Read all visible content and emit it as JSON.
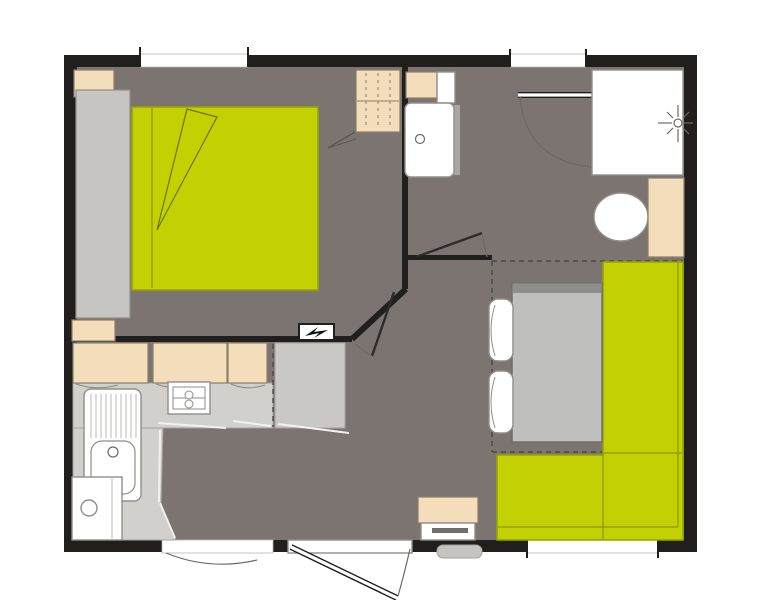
{
  "canvas": {
    "width": 769,
    "height": 600
  },
  "colors": {
    "wall": "#211f1d",
    "floor": "#7c7470",
    "accent": "#c3d102",
    "accentLine": "#95a300",
    "accentSeam": "#8a9600",
    "beige": "#f3ddbb",
    "beigeLine": "#8b7e68",
    "gray": "#c6c5c2",
    "gray2": "#c9c8c5",
    "grayLine": "#8f8e8b",
    "counter": "#d1d0cd",
    "counterLine": "#a3a29f",
    "fixture": "#ffffff",
    "fixtureLine": "#908f8c",
    "winLine": "#b9b8b5",
    "dash": "#4b4844",
    "swing": "#6b6a67",
    "leafThin": "#2e2c2a",
    "highlight": "#f2f1ef",
    "drain": "#b9b8b5",
    "step": "#c6c4c1",
    "tableTop": "#bfbfbd",
    "tableEdge": "#6f6e6c",
    "tableShadow": "#8f8e8c",
    "bolt": "#111111",
    "heaterBar": "#6f6e6c",
    "shadowStrip": "#a8a6a2"
  },
  "elements": {
    "plan": "studio-floor-plan",
    "rooms": [
      "bedroom",
      "bathroom",
      "kitchen",
      "living-area"
    ],
    "bedroom_items": [
      "double-bed",
      "wardrobe",
      "nightstand",
      "low-cabinet",
      "hanging-closet",
      "electrical-panel"
    ],
    "bathroom_items": [
      "shower",
      "shower-head",
      "washbasin",
      "toilet",
      "bathroom-cabinet"
    ],
    "kitchen_items": [
      "wall-cabinets",
      "countertop",
      "cooktop",
      "kitchen-sink",
      "appliance",
      "fridge-unit"
    ],
    "living_items": [
      "corner-sofa",
      "dining-table",
      "chairs",
      "heater-cabinet",
      "entry-step"
    ],
    "openings": [
      "bedroom-window",
      "bathroom-window",
      "living-window",
      "entry-door",
      "secondary-opening",
      "bathroom-door",
      "toilet-door",
      "bedroom-door"
    ]
  }
}
